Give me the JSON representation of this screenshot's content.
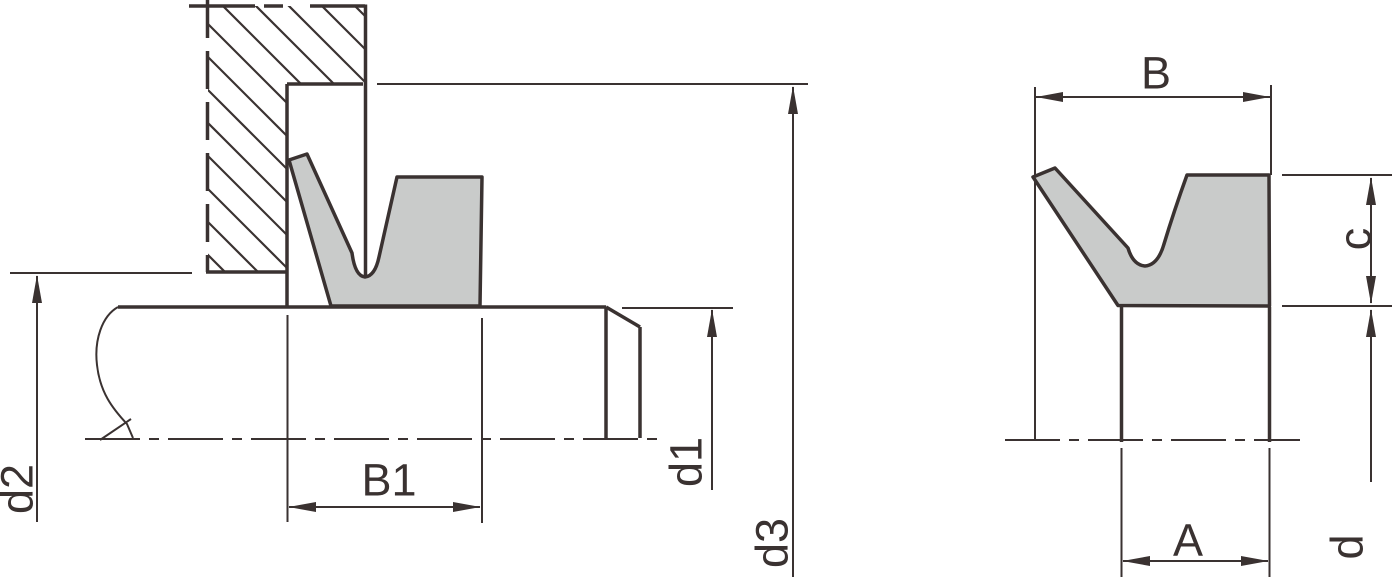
{
  "diagram": {
    "labels": {
      "d2": "d2",
      "B1": "B1",
      "d1": "d1",
      "d3": "d3",
      "B": "B",
      "c": "c",
      "A": "A",
      "d": "d"
    },
    "colors": {
      "line": "#3a3231",
      "seal_fill": "#c9cbca",
      "background": "#ffffff"
    }
  }
}
